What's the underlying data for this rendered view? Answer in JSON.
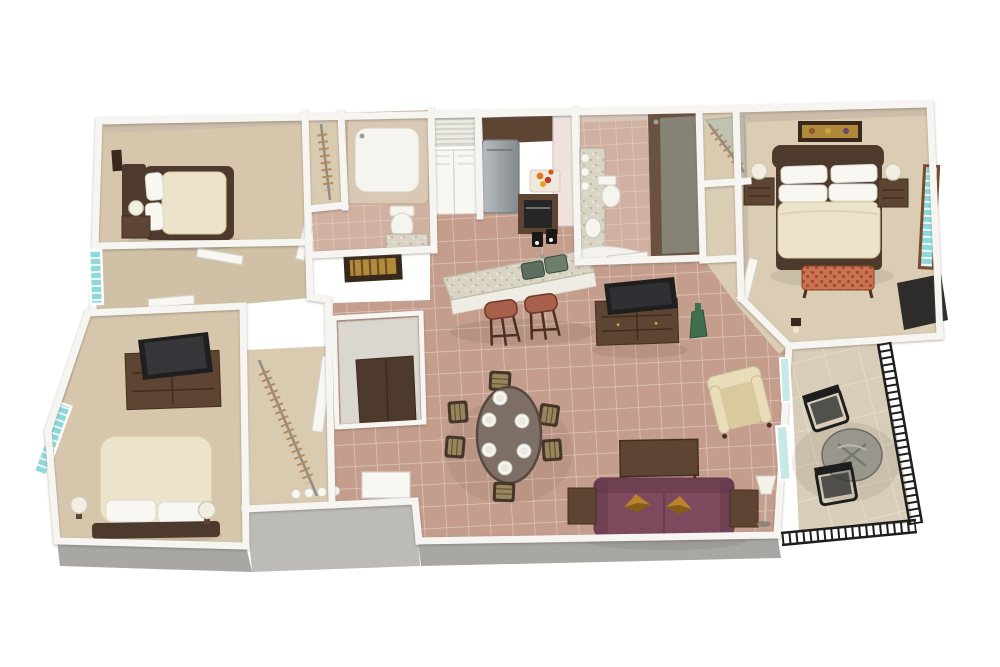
{
  "meta": {
    "alt": "3D rendered floor plan: three bedrooms, two bathrooms, kitchen with breakfast bar, dining table for six, living room with sofa and TV console, and a furnished balcony with railing."
  },
  "colors": {
    "bg": "#ffffff",
    "wall": "#f6f5f1",
    "wallEdge": "#d4d1ca",
    "faceTan": "#cbbda9",
    "facePink": "#e9dad4",
    "faceMauve": "#d8c6ba",
    "grayWall": "#a9a7a3",
    "grayWallLight": "#bdbbb7",
    "carpet": "#d6c7ac",
    "carpetMaster": "#dacdb3",
    "carpetHall": "#d0c1a6",
    "tile": "#c49d8c",
    "grout": "#e0c9bb",
    "tileBath": "#d0b0a0",
    "groutBath": "#e4cfc2",
    "balconyFloor": "#d8cdb9",
    "balconyGrout": "#e8dfcd",
    "woodDark": "#4e3a2c",
    "wood": "#5d4433",
    "woodLight": "#7a5a3e",
    "cream": "#ece3cb",
    "white": "#f8f7f2",
    "maroon": "#7c4a5c",
    "maroonDark": "#64374a",
    "goldPillow": "#b8832c",
    "goldDark": "#8a5c1a",
    "armCream": "#e9ddb9",
    "armCreamDark": "#d8c99e",
    "stoolSeat": "#a8604a",
    "stoolLeg": "#4a2f22",
    "tableTop": "#7d6e66",
    "tableEdge": "#57493f",
    "chairFrame": "#46362a",
    "chairPad": "#97865c",
    "granite": "#d9d4c3",
    "graniteDot": "#a39d86",
    "steelA": "#b9bdbf",
    "steelB": "#83898c",
    "teal": "#8fd8da",
    "tealLight": "#c6e8e6",
    "windowFrame": "#7a4a2a",
    "railing": "#1e1e1e",
    "glassTable": "#8e8e86",
    "showerTile": "#6a5240",
    "glass": "#a9bdb8",
    "vase": "#3f6f4f",
    "tv": "#1f1f1f",
    "bench": "#cb7350",
    "benchDark": "#a04f34",
    "artFrame": "#3a281c",
    "artGold": "#b08a3a",
    "oven": "#262626",
    "toilet": "#f5f4ef",
    "closetFloor": "#d9cbb0",
    "rodBrass": "#b58a5c",
    "utilGray": "#dad7d0"
  }
}
